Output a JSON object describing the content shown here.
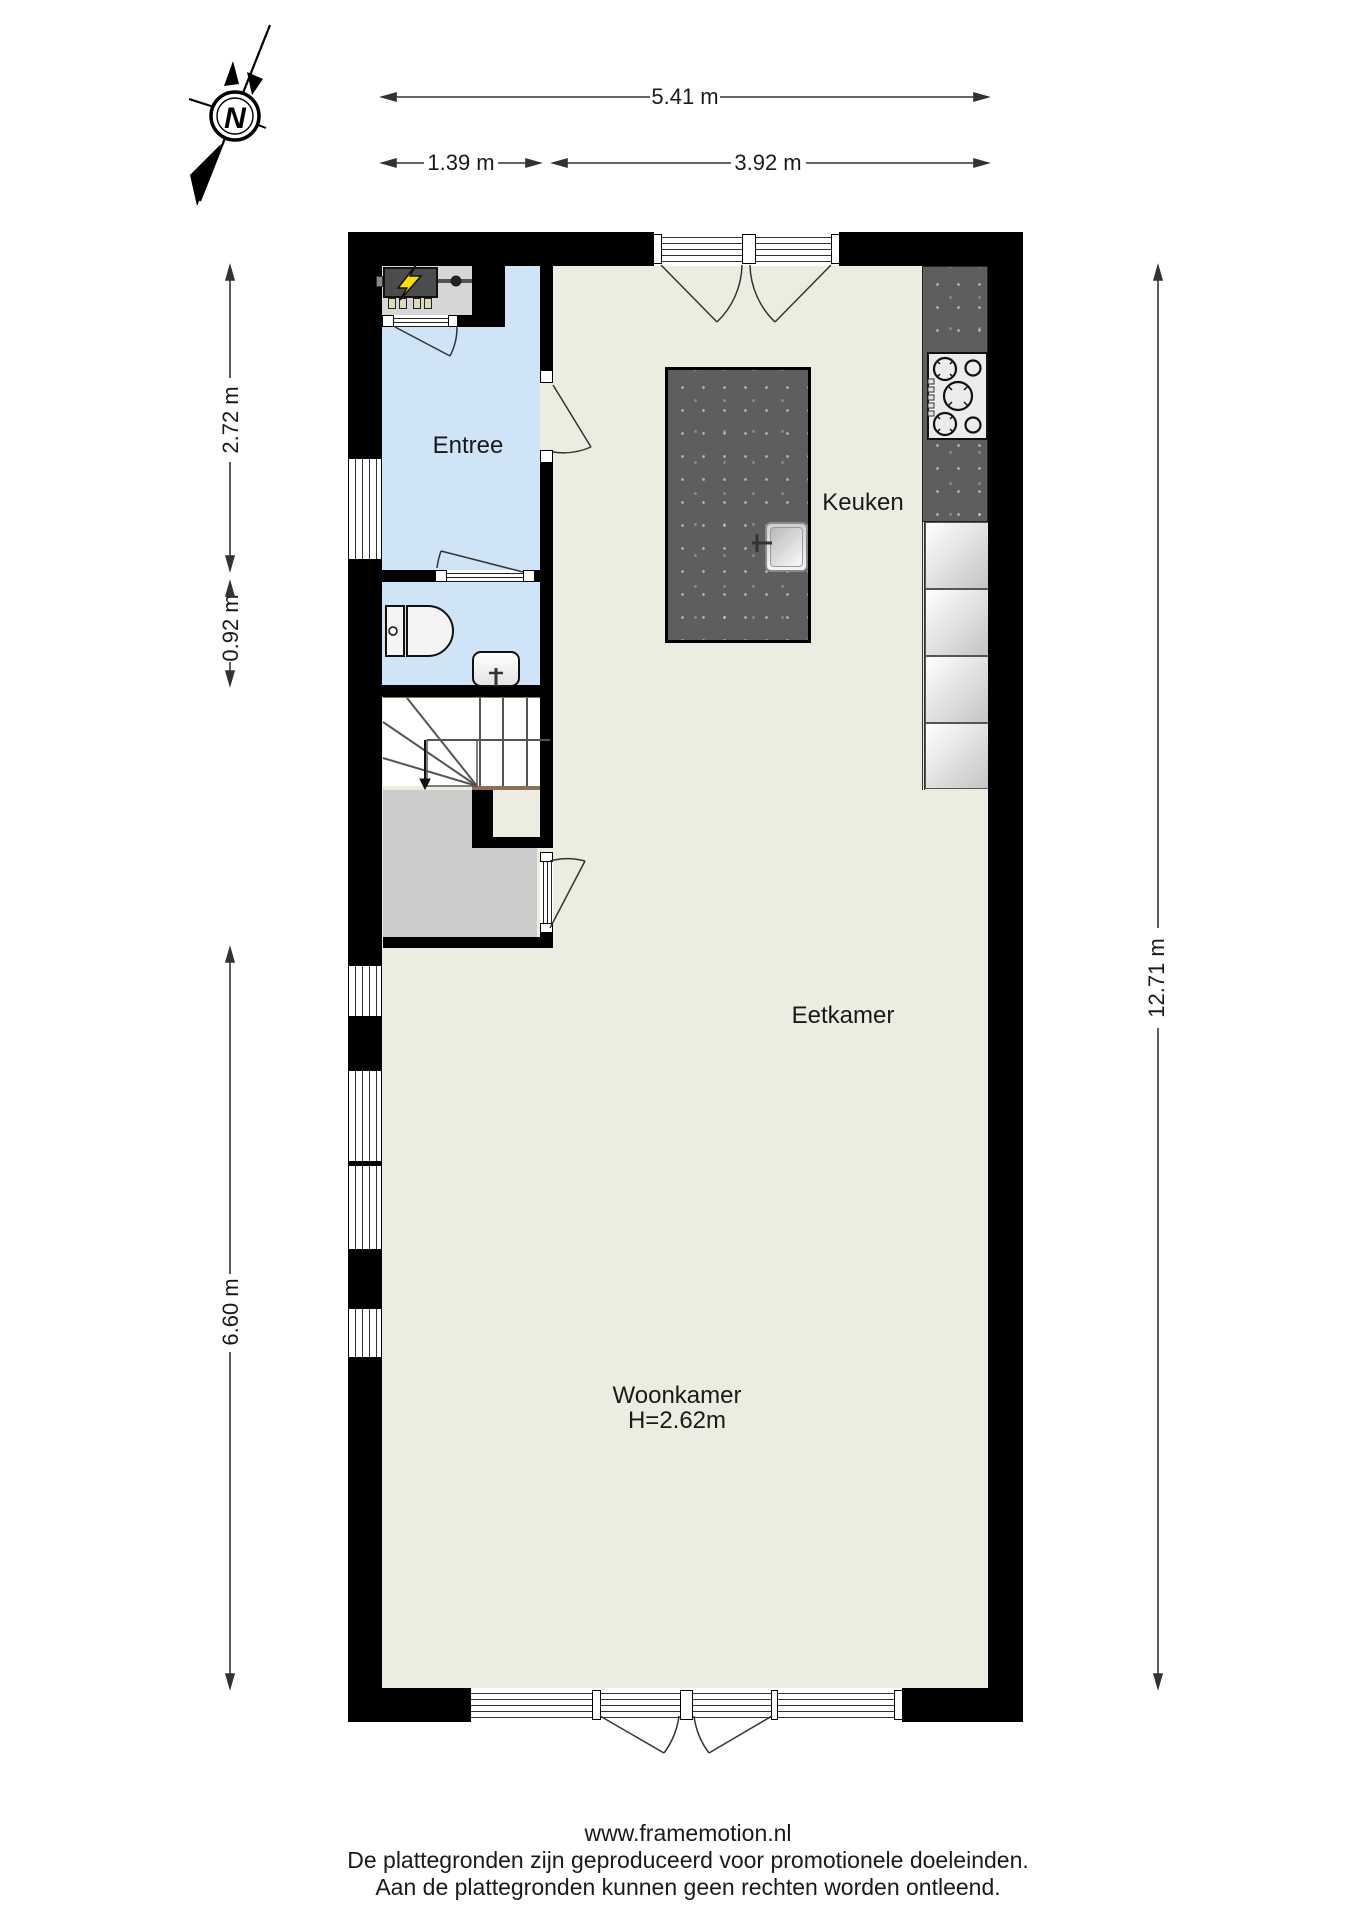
{
  "plan": {
    "rooms": {
      "entree": "Entree",
      "keuken": "Keuken",
      "eetkamer": "Eetkamer",
      "woonkamer": "Woonkamer",
      "woonkamer_ceiling_height": "H=2.62m"
    },
    "dimensions": {
      "total_width": "5.41 m",
      "entree_width": "1.39 m",
      "keuken_width": "3.92 m",
      "entree_depth": "2.72 m",
      "toilet_depth": "0.92 m",
      "woonkamer_depth": "6.60 m",
      "total_depth": "12.71 m"
    },
    "compass": {
      "north_label": "N"
    }
  },
  "footer": {
    "website": "www.framemotion.nl",
    "disclaimer_line1": "De plattegronden zijn geproduceerd voor promotionele doeleinden.",
    "disclaimer_line2": "Aan de plattegronden kunnen geen rechten worden ontleend."
  },
  "colors": {
    "wall": "#000000",
    "floor_main": "#edece1",
    "floor_wet_rooms": "#cfe4f6",
    "kitchen_island": "#5e5e5e",
    "stair_closet": "#cbcbcb",
    "stair_edge": "#8a7054",
    "meter_cabinet_floor": "#d6d6d6",
    "lightning_bolt": "#ffdf00",
    "text": "#1a1a1a"
  }
}
